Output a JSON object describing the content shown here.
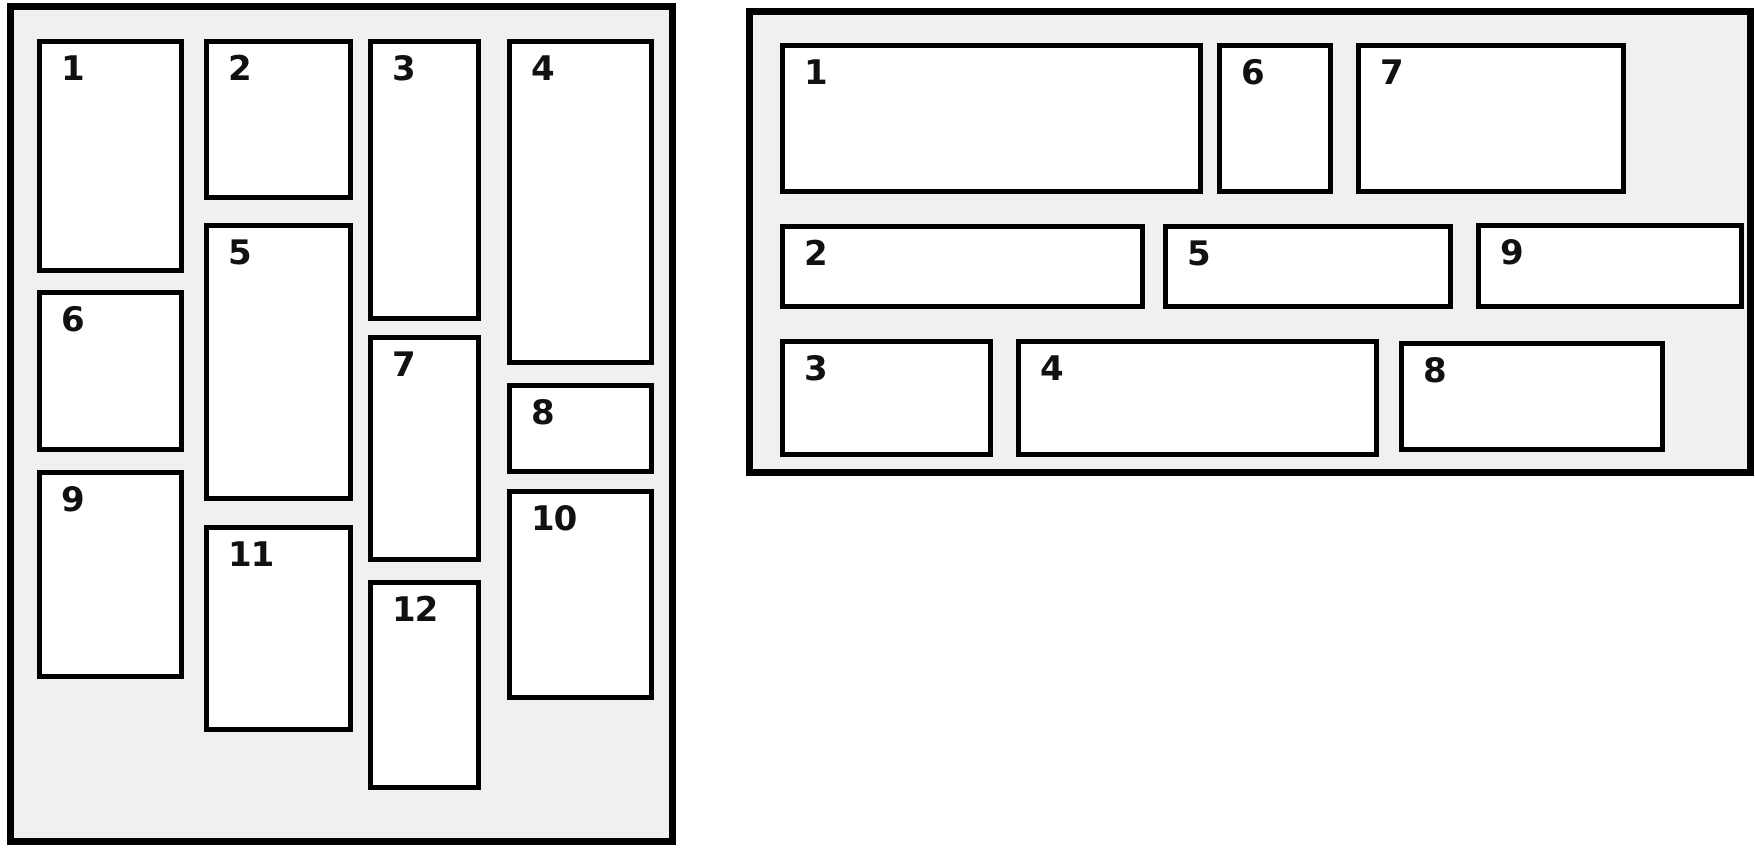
{
  "left_panel": {
    "labels": [
      "1",
      "2",
      "3",
      "4",
      "5",
      "6",
      "7",
      "8",
      "9",
      "10",
      "11",
      "12"
    ]
  },
  "right_panel": {
    "labels": [
      "1",
      "2",
      "3",
      "4",
      "5",
      "6",
      "7",
      "8",
      "9"
    ]
  },
  "colors": {
    "panel_background": "#f0f0f0",
    "box_background": "#ffffff",
    "border": "#000000",
    "label_text": "#111111"
  }
}
